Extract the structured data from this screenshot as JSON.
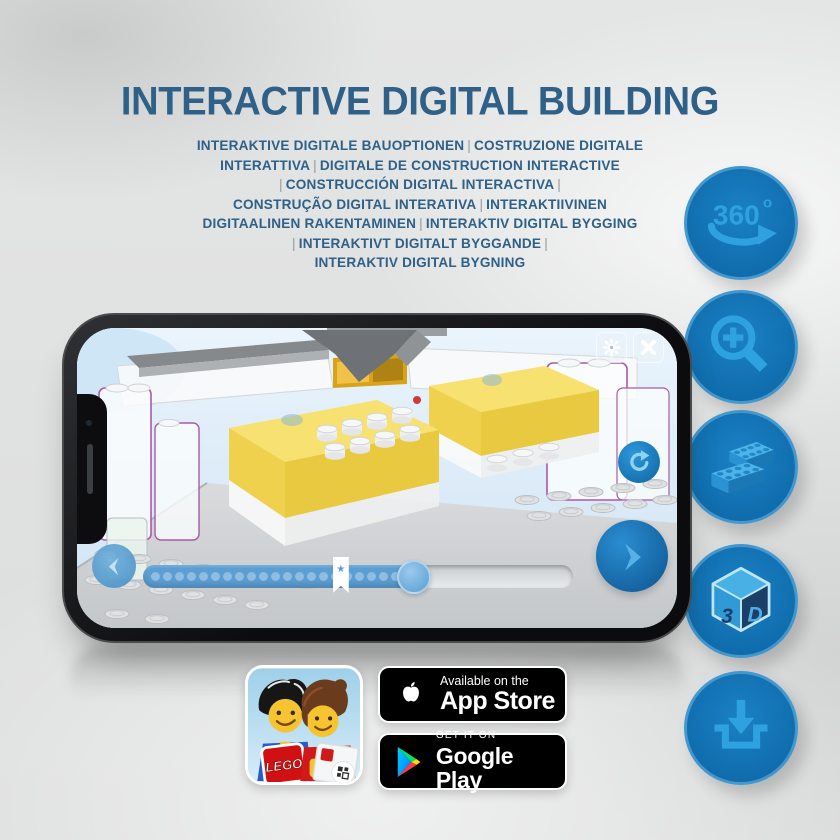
{
  "header": {
    "title": "INTERACTIVE DIGITAL BUILDING",
    "subtitle_lines": [
      "INTERAKTIVE DIGITALE BAUOPTIONEN | COSTRUZIONE DIGITALE",
      "INTERATTIVA | DIGITALE DE CONSTRUCTION INTERACTIVE",
      "| CONSTRUCCIÓN DIGITAL INTERACTIVA |",
      "CONSTRUÇÃO DIGITAL INTERATIVA | INTERAKTIIVINEN",
      "DIGITAALINEN RAKENTAMINEN | INTERAKTIV DIGITAL BYGGING",
      "| INTERAKTIVT DIGITALT BYGGANDE |",
      "INTERAKTIV DIGITAL BYGNING"
    ]
  },
  "features": [
    {
      "icon": "360-rotate-icon",
      "label": "360",
      "sup": "o"
    },
    {
      "icon": "zoom-in-magnifier-icon"
    },
    {
      "icon": "lego-bricks-icon"
    },
    {
      "icon": "3d-cube-icon",
      "face_left": "3",
      "face_right": "D"
    },
    {
      "icon": "download-icon"
    }
  ],
  "phone": {
    "screen_ui": {
      "settings_icon": "gear-icon",
      "close_icon": "close-icon",
      "rotate_reset_icon": "rotate-arrow-icon",
      "back_icon": "chevron-left-icon",
      "next_icon": "chevron-right-icon",
      "bookmark_star": "★",
      "progress": {
        "dots": 22,
        "filled_percent": 67,
        "bookmark_percent": 46,
        "knob_percent": 63
      }
    }
  },
  "badges": {
    "lego_app_logo_text": "LEGO",
    "app_store": {
      "tagline": "Available on the",
      "store_name": "App Store"
    },
    "google_play": {
      "tagline": "GET IT ON",
      "store_name": "Google Play"
    }
  },
  "colors": {
    "title_blue": "#2e6088",
    "circle_blue": "#0f6bab",
    "icon_light_blue": "#2ea2e0",
    "highlight_yellow": "#f0d14e",
    "outline_purple": "#a85aa8"
  }
}
